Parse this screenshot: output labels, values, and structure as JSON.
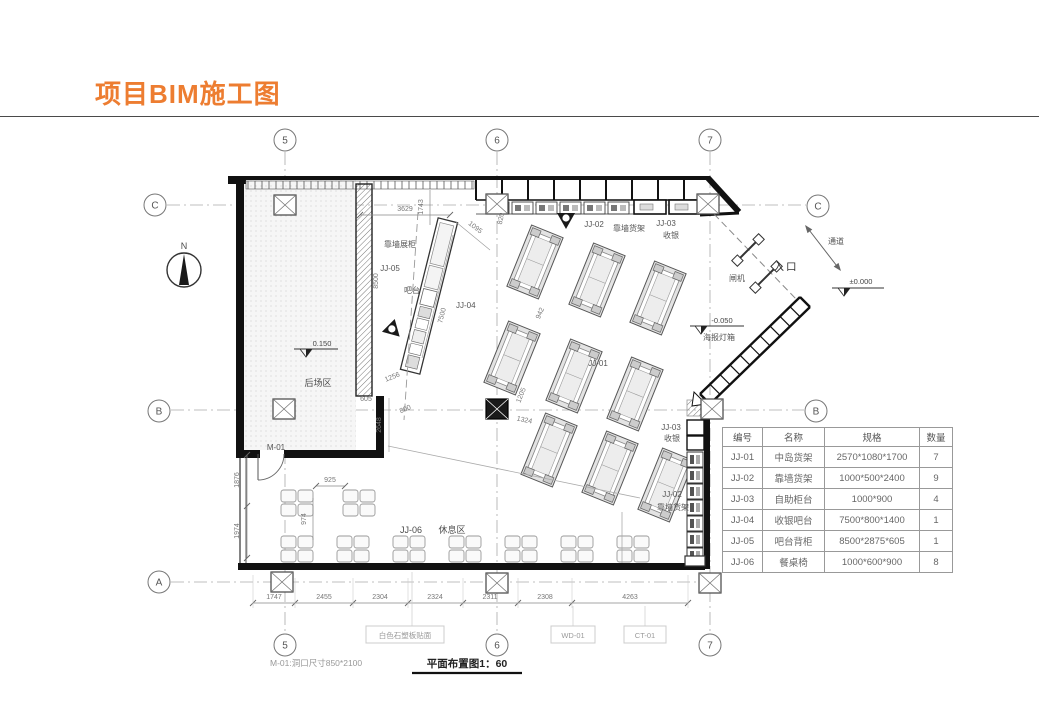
{
  "colors": {
    "accent_orange": "#ED7D31",
    "line_dark": "#111111",
    "dim_gray": "#777777"
  },
  "title": "项目BIM施工图",
  "grid": {
    "g5": "5",
    "g6": "6",
    "g7": "7",
    "gA": "A",
    "gB": "B",
    "gC": "C"
  },
  "north_label": "N",
  "labels": {
    "wall_display": "靠墙展柜",
    "jj05": "JJ-05",
    "bar": "吧台",
    "jj04": "JJ-04",
    "jj01": "JJ-01",
    "jj02_top": "JJ-02",
    "wall_shelf_top": "靠墙货架",
    "jj03_top": "JJ-03",
    "cashier_top": "收银",
    "jj03_right": "JJ-03",
    "cashier_right": "收银",
    "jj02_right": "JJ-02",
    "wall_shelf_right": "靠墙货架",
    "backroom": "后场区",
    "m01": "M-01",
    "jj06": "JJ-06",
    "rest_area": "休息区",
    "entrance": "入口",
    "turnstile": "闸机",
    "passage": "通道",
    "poster_lightbox": "海报灯箱"
  },
  "elevations": {
    "backroom": "0.150",
    "entry": "-0.050",
    "ground": "±0.000"
  },
  "dims": {
    "d3629": "3629",
    "d1743": "1743",
    "d1095": "1095",
    "d820": "820",
    "d8500": "8500",
    "d7500": "7500",
    "d942": "942",
    "d1256": "1256",
    "d800": "800",
    "d2648": "2648",
    "d605": "605",
    "d1205": "1205",
    "d1324": "1324",
    "d925": "925",
    "d974": "974",
    "d1876": "1876",
    "d1974": "1974",
    "bottom": [
      "1747",
      "2455",
      "2304",
      "2324",
      "2311",
      "2308",
      "4263"
    ]
  },
  "finish_tags": {
    "stone": "白色石塑板贴面",
    "wd": "WD-01",
    "ct": "CT-01"
  },
  "notes": {
    "m01_note": "M-01:洞口尺寸850*2100",
    "drawing_title": "平面布置图1：60"
  },
  "schedule": {
    "headers": [
      "编号",
      "名称",
      "规格",
      "数量"
    ],
    "rows": [
      [
        "JJ-01",
        "中岛货架",
        "2570*1080*1700",
        "7"
      ],
      [
        "JJ-02",
        "靠墙货架",
        "1000*500*2400",
        "9"
      ],
      [
        "JJ-03",
        "自助柜台",
        "1000*900",
        "4"
      ],
      [
        "JJ-04",
        "收银吧台",
        "7500*800*1400",
        "1"
      ],
      [
        "JJ-05",
        "吧台背柜",
        "8500*2875*605",
        "1"
      ],
      [
        "JJ-06",
        "餐桌椅",
        "1000*600*900",
        "8"
      ]
    ]
  }
}
